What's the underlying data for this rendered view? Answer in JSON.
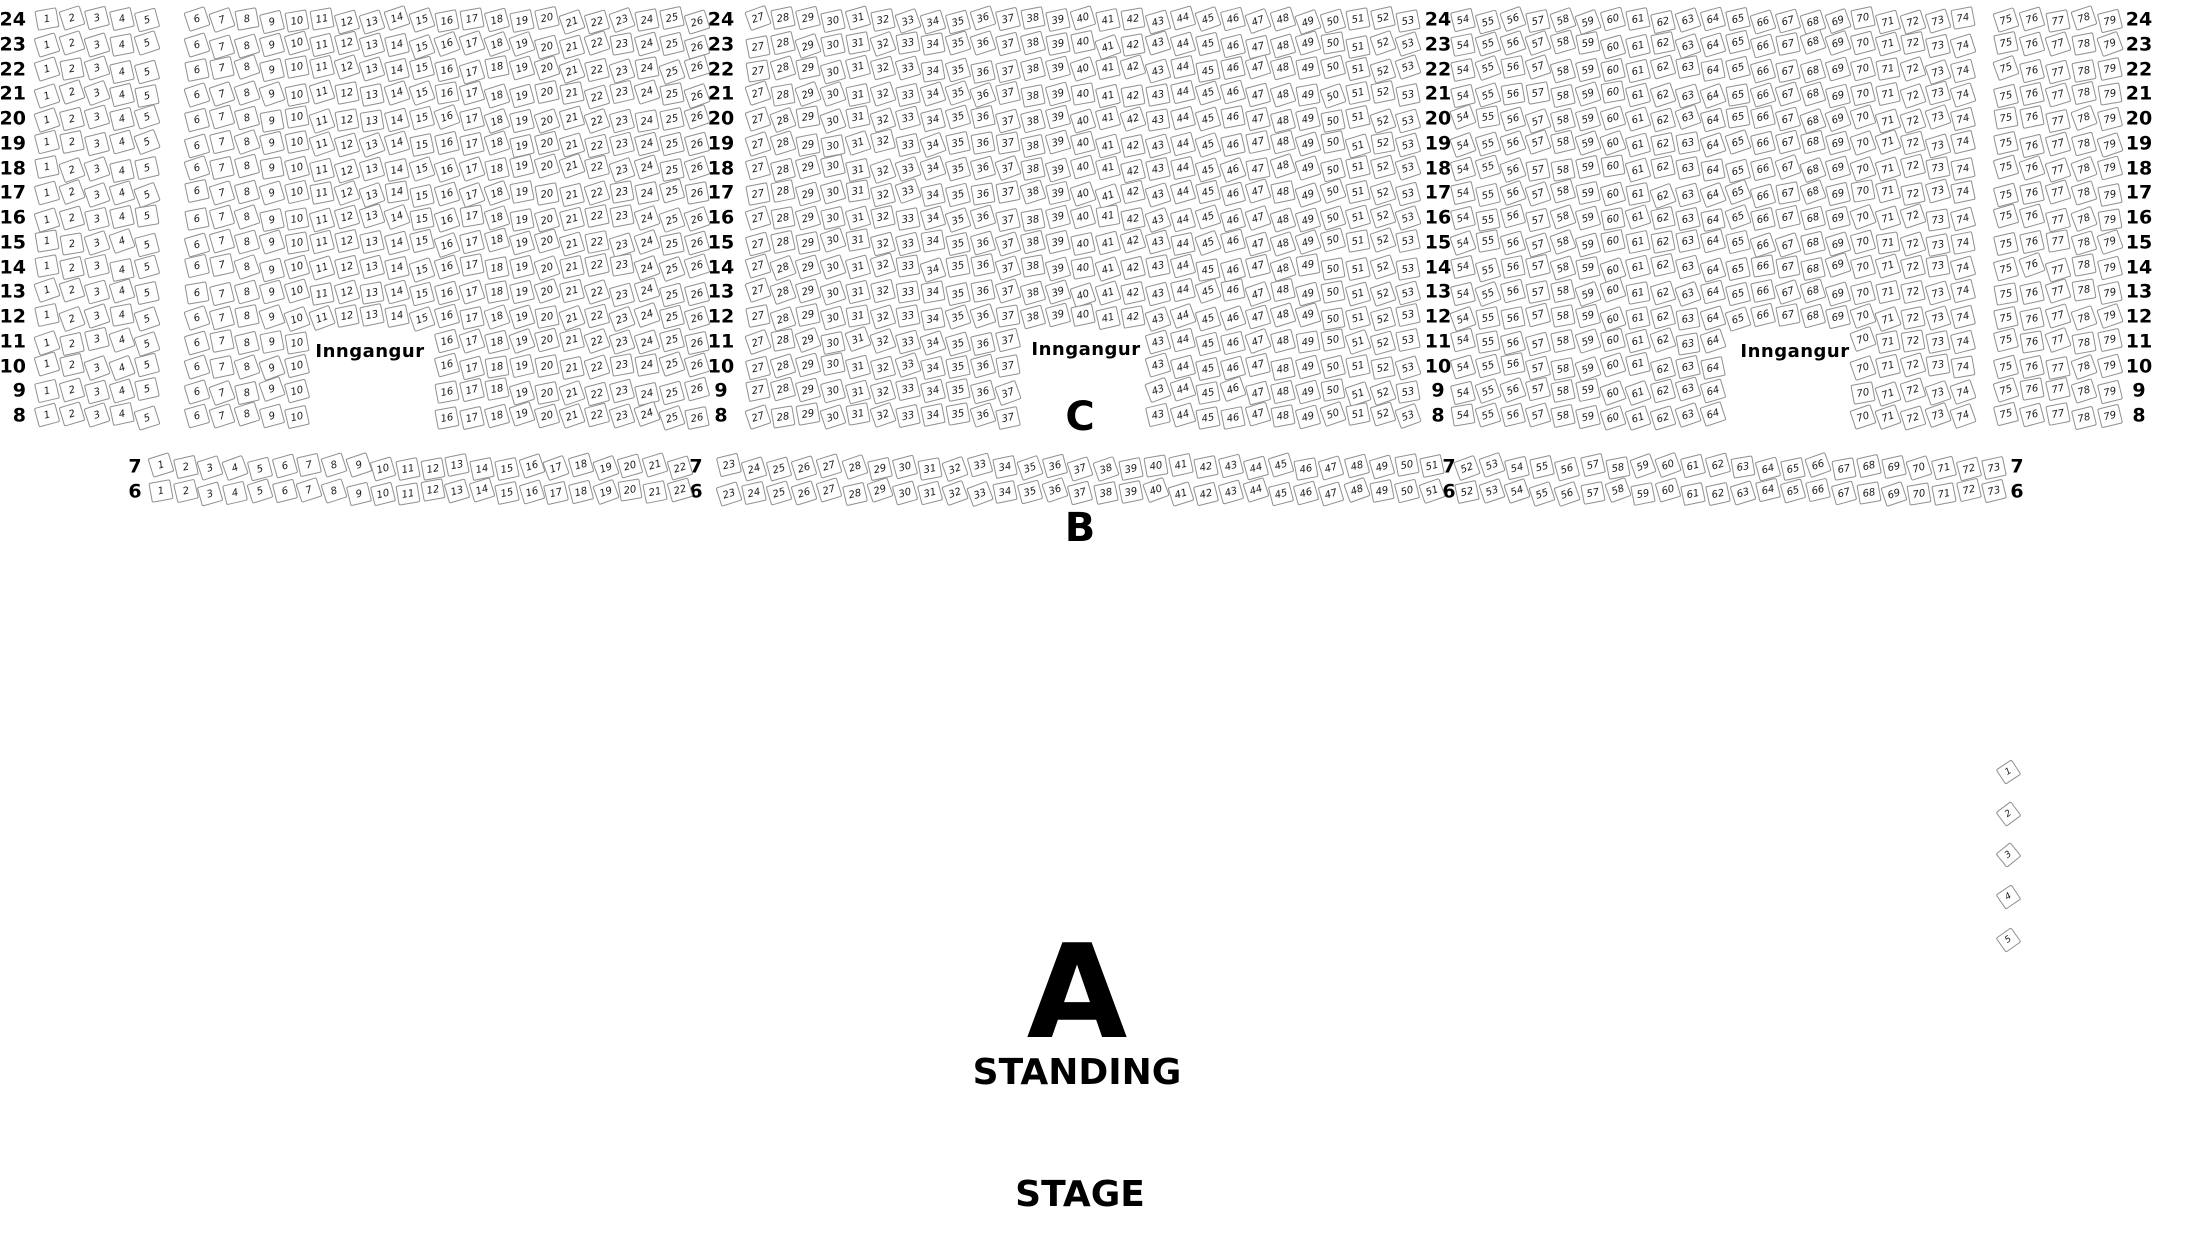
{
  "labels": {
    "entrance": "Inngangur",
    "section_a": "A",
    "section_b": "B",
    "section_c": "C",
    "standing": "STANDING",
    "stage": "STAGE"
  },
  "colors": {
    "seat_border": "#8f8f8f",
    "seat_fill": "#ffffff",
    "text": "#000000",
    "background": "#ffffff"
  },
  "main_grid": {
    "row_labels": [
      24,
      23,
      22,
      21,
      20,
      19,
      18,
      17,
      16,
      15,
      14,
      13,
      12,
      11,
      10,
      9,
      8
    ],
    "row_y_top": 20,
    "row_spacing": 24.75,
    "label_columns": [
      {
        "x": 26,
        "align": "right"
      },
      {
        "x": 721,
        "align": "center"
      },
      {
        "x": 1438,
        "align": "center"
      },
      {
        "x": 2139,
        "align": "center"
      }
    ],
    "blocks": [
      {
        "seat_from": 1,
        "seat_to": 5,
        "x_start": 47,
        "x_spacing": 25
      },
      {
        "seat_from": 6,
        "seat_to": 26,
        "x_start": 197,
        "x_spacing": 25,
        "gap_rows": [
          11,
          10,
          9,
          8
        ],
        "gap_from": 11,
        "gap_to": 15
      },
      {
        "seat_from": 27,
        "seat_to": 53,
        "x_start": 758,
        "x_spacing": 25,
        "gap_rows": [
          11,
          10,
          9,
          8
        ],
        "gap_from": 38,
        "gap_to": 42
      },
      {
        "seat_from": 54,
        "seat_to": 74,
        "x_start": 1463,
        "x_spacing": 25,
        "gap_rows": [
          11,
          10,
          9,
          8
        ],
        "gap_from": 65,
        "gap_to": 69
      },
      {
        "seat_from": 75,
        "seat_to": 79,
        "x_start": 2006,
        "x_spacing": 26
      }
    ],
    "entrances": [
      {
        "x": 370,
        "y": 352
      },
      {
        "x": 1086,
        "y": 350
      },
      {
        "x": 1795,
        "y": 352
      }
    ]
  },
  "b_grid": {
    "rows": [
      {
        "label": 7,
        "y": 467
      },
      {
        "label": 6,
        "y": 492
      }
    ],
    "label_columns": [
      {
        "x": 135,
        "align": "center"
      },
      {
        "x": 696,
        "align": "center"
      },
      {
        "x": 1449,
        "align": "center"
      },
      {
        "x": 2017,
        "align": "center"
      }
    ],
    "blocks": [
      {
        "seat_from": 1,
        "seat_to": 22,
        "x_start": 161,
        "x_spacing": 24.7
      },
      {
        "seat_from": 23,
        "seat_to": 51,
        "x_start": 729,
        "x_spacing": 25.1
      },
      {
        "seat_from": 52,
        "seat_to": 73,
        "x_start": 1467,
        "x_spacing": 25.1
      }
    ]
  },
  "side_seats": {
    "numbers": [
      1,
      2,
      3,
      4,
      5
    ],
    "x": 2008,
    "y_start": 772,
    "y_spacing": 42
  }
}
